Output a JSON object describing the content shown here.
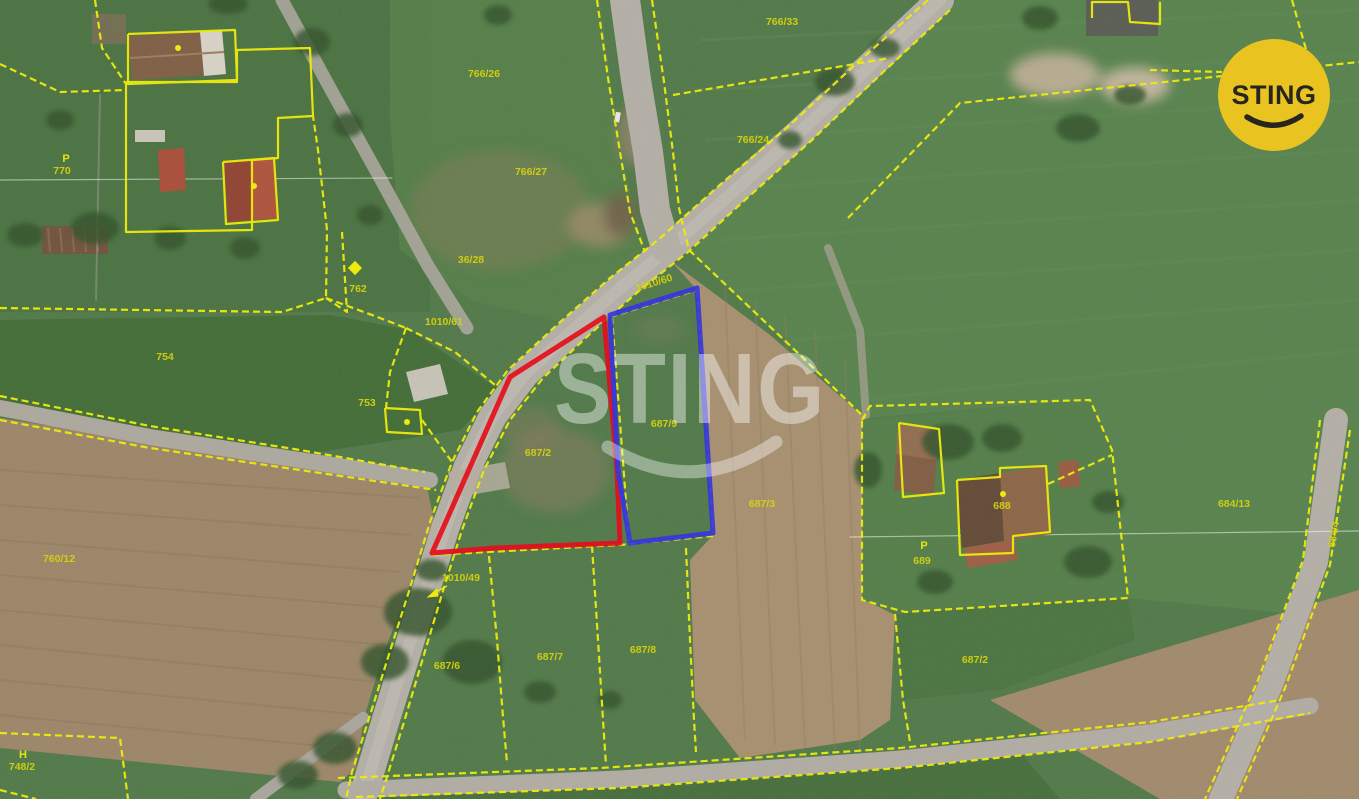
{
  "map": {
    "watermark": {
      "text": "STING"
    },
    "logo": {
      "text": "STING"
    },
    "colors": {
      "parcel_line": "#f0ee00",
      "label_text": "#d6d200",
      "highlight_red": "#e60012",
      "highlight_blue": "#2b2be0",
      "logo_bg": "#e9c320",
      "logo_text": "#26261f"
    },
    "parcel_labels": [
      {
        "text": "766/33",
        "x": 782,
        "y": 25
      },
      {
        "text": "766/26",
        "x": 484,
        "y": 77
      },
      {
        "text": "766/24",
        "x": 753,
        "y": 143
      },
      {
        "text": "766/27",
        "x": 531,
        "y": 175
      },
      {
        "text": "770",
        "x": 62,
        "y": 174
      },
      {
        "text": "36/28",
        "x": 471,
        "y": 263
      },
      {
        "text": "762",
        "x": 358,
        "y": 292
      },
      {
        "text": "1010/61",
        "x": 444,
        "y": 325
      },
      {
        "text": "1010/60",
        "x": 655,
        "y": 286,
        "rot": -17
      },
      {
        "text": "754",
        "x": 165,
        "y": 360
      },
      {
        "text": "753",
        "x": 367,
        "y": 406
      },
      {
        "text": "687/9",
        "x": 664,
        "y": 427
      },
      {
        "text": "687/2",
        "x": 538,
        "y": 456
      },
      {
        "text": "687/3",
        "x": 762,
        "y": 507
      },
      {
        "text": "684/13",
        "x": 1234,
        "y": 507
      },
      {
        "text": "688",
        "x": 1002,
        "y": 509
      },
      {
        "text": "689",
        "x": 922,
        "y": 564
      },
      {
        "text": "760/12",
        "x": 59,
        "y": 562
      },
      {
        "text": "1010/49",
        "x": 461,
        "y": 581
      },
      {
        "text": "687/6",
        "x": 447,
        "y": 669
      },
      {
        "text": "687/7",
        "x": 550,
        "y": 660
      },
      {
        "text": "687/8",
        "x": 643,
        "y": 653
      },
      {
        "text": "687/2",
        "x": 975,
        "y": 663
      },
      {
        "text": "748/2",
        "x": 22,
        "y": 770
      },
      {
        "text": "684/4",
        "x": 1337,
        "y": 535,
        "rot": -80
      }
    ],
    "map_symbols": [
      {
        "glyph": "P",
        "x": 66,
        "y": 162
      },
      {
        "glyph": "P",
        "x": 924,
        "y": 549
      },
      {
        "glyph": "H",
        "x": 23,
        "y": 758
      }
    ],
    "markers": [
      {
        "type": "dot",
        "x": 178,
        "y": 48
      },
      {
        "type": "dot",
        "x": 254,
        "y": 186
      },
      {
        "type": "dot",
        "x": 1003,
        "y": 494
      },
      {
        "type": "dot",
        "x": 407,
        "y": 422
      },
      {
        "type": "diamond",
        "x": 355,
        "y": 268
      }
    ],
    "highlight_parcels": [
      {
        "name": "red-parcel",
        "color": "#e60012",
        "points": "604,317 617,470 620,543 495,548 432,553 510,377"
      },
      {
        "name": "blue-parcel",
        "color": "#2b2be0",
        "points": "610,315 697,288 713,533 630,543 618,470"
      }
    ]
  }
}
